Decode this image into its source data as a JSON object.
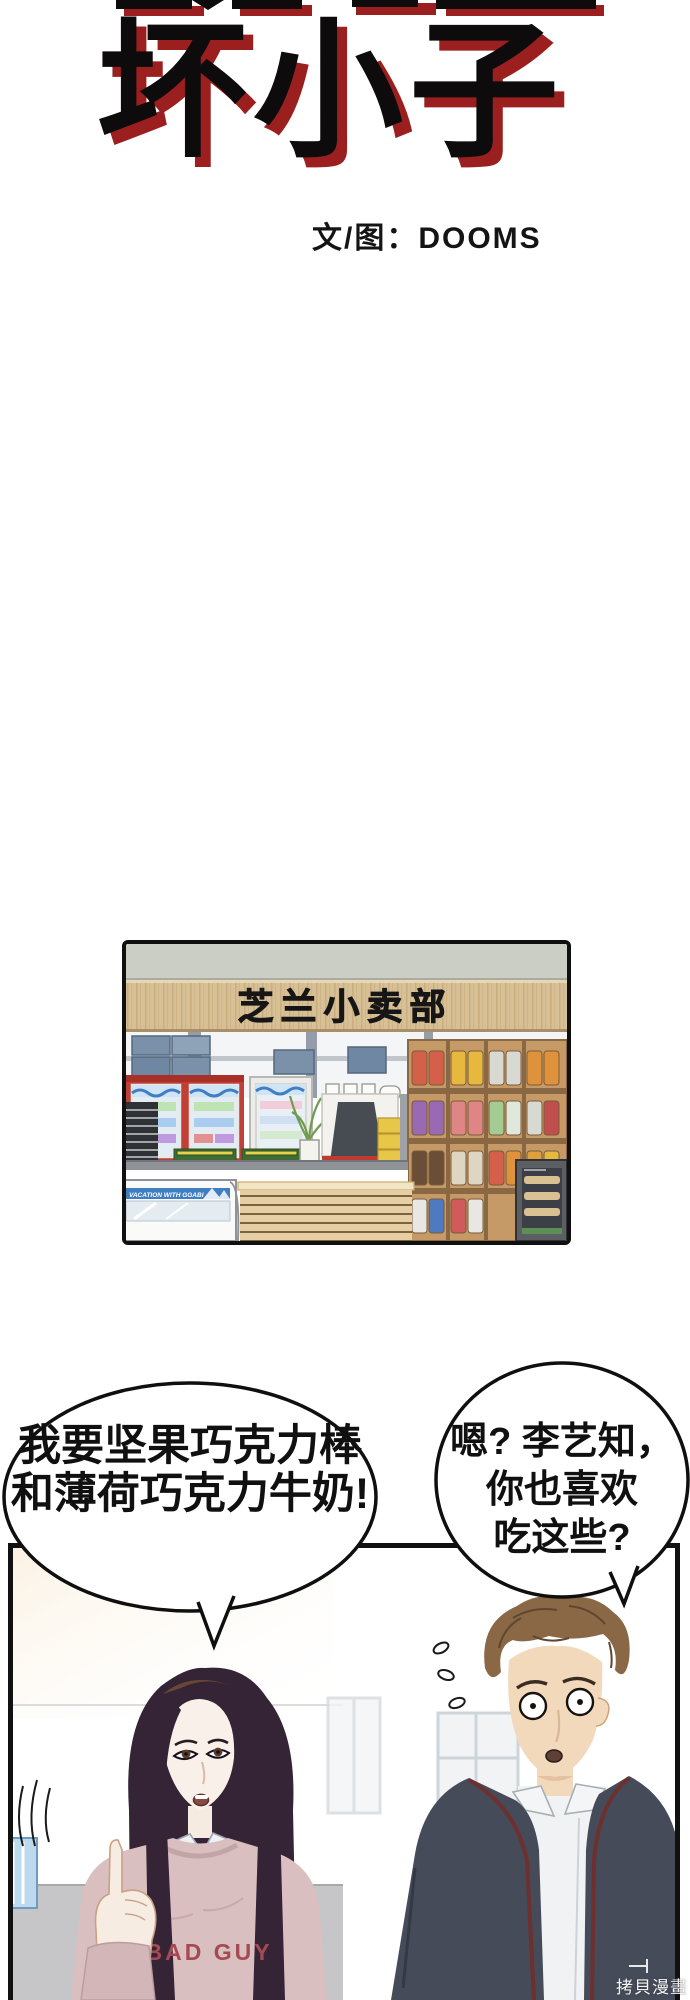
{
  "title": {
    "main": "坏小子",
    "credit": "文/图：DOOMS",
    "text_color": "#0d0b0b",
    "shadow_color": "#9b1f1f"
  },
  "store_panel": {
    "sign": "芝兰小卖部",
    "freezer_banner": "VACATION WITH GGABI"
  },
  "bubbles": {
    "left": {
      "lines": [
        "我要坚果巧克力棒",
        "和薄荷巧克力牛奶!"
      ]
    },
    "right": {
      "lines": [
        "嗯? 李艺知，",
        "你也喜欢",
        "吃这些?"
      ]
    }
  },
  "panel2": {
    "shirt_text": "BAD GUY"
  },
  "watermark": "拷貝漫畫",
  "colors": {
    "accent_red": "#9b1f1f",
    "sweater_pink": "#d9bfc0",
    "jacket": "#454b59",
    "jacket_trim": "#6e2f2f",
    "freezer_blue": "#3f7ec2",
    "sign_wood": "#d8c096"
  }
}
